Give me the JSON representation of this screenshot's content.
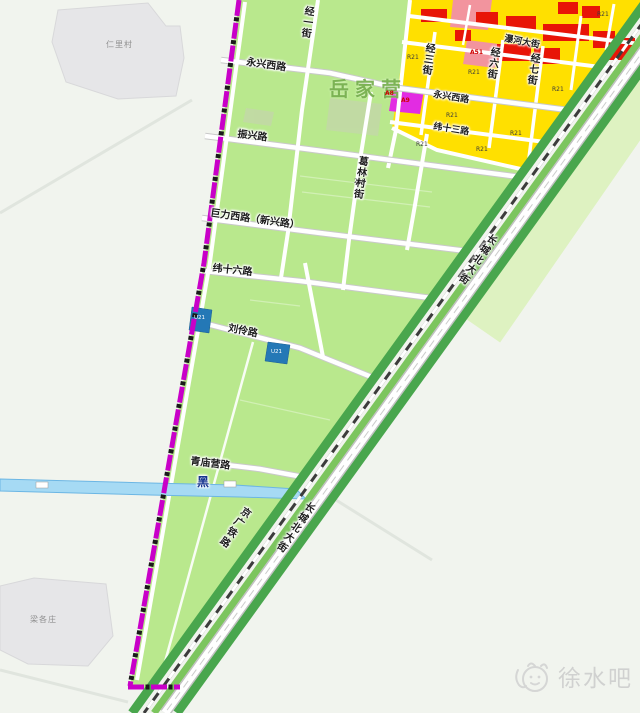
{
  "map": {
    "colors": {
      "background": "#f1f4ee",
      "plan_area_green": "#b9e88d",
      "zoning_yellow": "#ffe000",
      "zoning_red": "#e81507",
      "zoning_pink": "#f2949e",
      "zoning_magenta": "#e22ce2",
      "utility_blue": "#2478b6",
      "corridor_green": "#49a64d",
      "pale_green": "#def2c1",
      "river_blue": "#a6daf4",
      "boundary_magenta": "#c800c8",
      "village_gray": "#e6e6e8",
      "watermark_gray": "#c9c9c9"
    },
    "watermark": {
      "text": "徐水吧"
    },
    "labels": [
      {
        "name": "village-label-renlicun",
        "text": "仁里村",
        "x": 106,
        "y": 41,
        "style": "village"
      },
      {
        "name": "village-label-lianggezhuang",
        "text": "梁各庄",
        "x": 30,
        "y": 616,
        "style": "village"
      },
      {
        "name": "area-label-yuejiaying",
        "text": "岳家营",
        "x": 329,
        "y": 79,
        "style": "area"
      },
      {
        "name": "road-label-yongxing-west-1",
        "text": "永兴西路",
        "x": 247,
        "y": 58,
        "rot": 8,
        "style": "road"
      },
      {
        "name": "road-label-jing1-street",
        "text": "经一街",
        "x": 303,
        "y": 5,
        "rot": 8,
        "vertical": true,
        "style": "road"
      },
      {
        "name": "road-label-jing3-street",
        "text": "经三街",
        "x": 424,
        "y": 42,
        "rot": 8,
        "vertical": true,
        "style": "road"
      },
      {
        "name": "road-label-jing6-street",
        "text": "经六街",
        "x": 489,
        "y": 46,
        "rot": 8,
        "vertical": true,
        "style": "road"
      },
      {
        "name": "road-label-jing7-street",
        "text": "经七街",
        "x": 529,
        "y": 52,
        "rot": 8,
        "vertical": true,
        "style": "road"
      },
      {
        "name": "road-label-puhe-avenue",
        "text": "瀑河大街",
        "x": 505,
        "y": 35,
        "rot": 11,
        "style": "road-sm"
      },
      {
        "name": "road-label-yongxing-west-2",
        "text": "永兴西路",
        "x": 434,
        "y": 91,
        "rot": 9,
        "style": "road-sm"
      },
      {
        "name": "road-label-wei13",
        "text": "纬十三路",
        "x": 434,
        "y": 123,
        "rot": 9,
        "style": "road-sm"
      },
      {
        "name": "road-label-zhenxing",
        "text": "振兴路",
        "x": 238,
        "y": 130,
        "rot": 7,
        "style": "road"
      },
      {
        "name": "road-label-gelin-village-street",
        "text": "葛林村街",
        "x": 357,
        "y": 155,
        "rot": 8,
        "vertical": true,
        "style": "road"
      },
      {
        "name": "road-label-juli-west",
        "text": "巨力西路（新兴路）",
        "x": 211,
        "y": 209,
        "rot": 8,
        "style": "road"
      },
      {
        "name": "road-label-wei16",
        "text": "纬十六路",
        "x": 213,
        "y": 264,
        "rot": 6,
        "style": "road"
      },
      {
        "name": "road-label-liuling",
        "text": "刘伶路",
        "x": 229,
        "y": 324,
        "rot": 11,
        "style": "road"
      },
      {
        "name": "road-label-qingmiaoying",
        "text": "青庙营路",
        "x": 191,
        "y": 457,
        "rot": 7,
        "style": "road"
      },
      {
        "name": "river-label-hei",
        "text": "黑",
        "x": 197,
        "y": 476,
        "style": "river-name"
      },
      {
        "name": "railway-label-jingguang",
        "text": "京广铁路",
        "x": 243,
        "y": 504,
        "rot": 35,
        "vertical": true,
        "style": "railway"
      },
      {
        "name": "road-label-changcheng-north-1",
        "text": "长城北大街",
        "x": 489,
        "y": 231,
        "rot": 35,
        "vertical": true,
        "style": "corridor"
      },
      {
        "name": "road-label-changcheng-north-2",
        "text": "长城北大街",
        "x": 307,
        "y": 499,
        "rot": 35,
        "vertical": true,
        "style": "corridor"
      },
      {
        "name": "zone-label-a8",
        "text": "A8",
        "x": 385,
        "y": 91,
        "style": "zone-red"
      },
      {
        "name": "zone-label-a9",
        "text": "A9",
        "x": 401,
        "y": 98,
        "style": "zone-red"
      },
      {
        "name": "zone-label-a51",
        "text": "A51",
        "x": 470,
        "y": 50,
        "style": "zone-red"
      },
      {
        "name": "zone-label-r21-1",
        "text": "R21",
        "x": 407,
        "y": 55,
        "style": "zone"
      },
      {
        "name": "zone-label-r21-2",
        "text": "R21",
        "x": 468,
        "y": 70,
        "style": "zone"
      },
      {
        "name": "zone-label-r21-3",
        "text": "R21",
        "x": 446,
        "y": 113,
        "style": "zone"
      },
      {
        "name": "zone-label-r21-4",
        "text": "R21",
        "x": 476,
        "y": 147,
        "style": "zone"
      },
      {
        "name": "zone-label-r21-5",
        "text": "R21",
        "x": 416,
        "y": 142,
        "style": "zone"
      },
      {
        "name": "zone-label-r21-6",
        "text": "R21",
        "x": 552,
        "y": 87,
        "style": "zone"
      },
      {
        "name": "zone-label-r21-7",
        "text": "R21",
        "x": 597,
        "y": 12,
        "style": "zone"
      },
      {
        "name": "zone-label-r21-8",
        "text": "R21",
        "x": 510,
        "y": 131,
        "style": "zone"
      },
      {
        "name": "zone-label-216",
        "text": "216",
        "x": 354,
        "y": 179,
        "style": "zone"
      },
      {
        "name": "zone-label-u21-1",
        "text": "U21",
        "x": 194,
        "y": 316,
        "style": "zone-white"
      },
      {
        "name": "zone-label-u21-2",
        "text": "U21",
        "x": 271,
        "y": 350,
        "style": "zone-white"
      }
    ]
  }
}
